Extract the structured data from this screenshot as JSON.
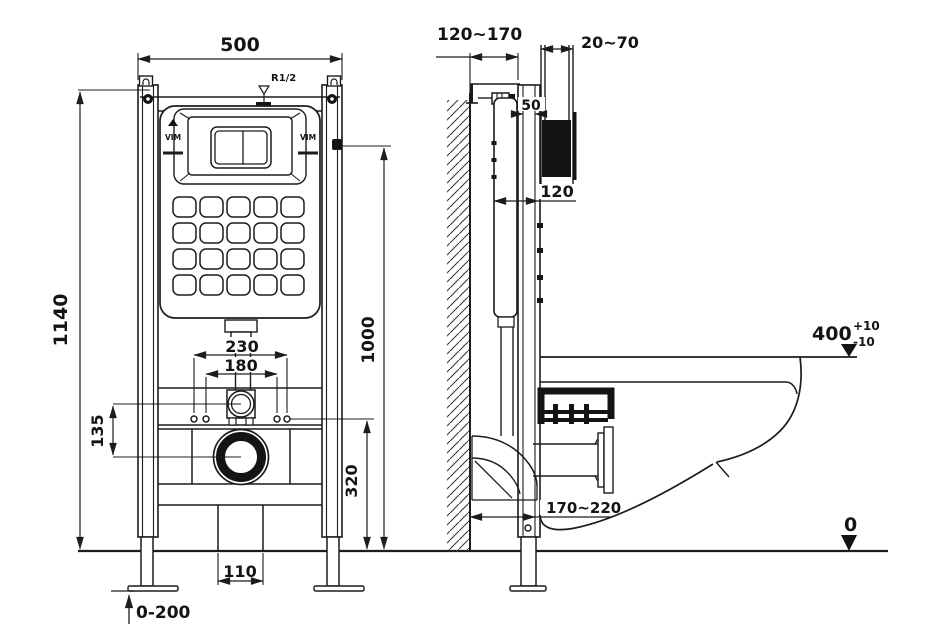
{
  "drawing": {
    "front_view": {
      "frame_width": "500",
      "frame_height": "1140",
      "flush_pipe_spacing": "230",
      "bolt_spacing": "180",
      "axis_offset": "135",
      "outlet_height": "320",
      "upper_height": "1000",
      "floor_bracket_width": "110",
      "leg_adjust": "0-200",
      "inlet_thread": "R1/2",
      "brand": "VIM"
    },
    "side_view": {
      "install_depth_top": "120~170",
      "finish_depth": "20~70",
      "rail_depth": "50",
      "frame_depth": "120",
      "bowl_height": "400",
      "bowl_height_plus": "+10",
      "bowl_height_minus": "-10",
      "install_depth_bottom": "170~220",
      "floor_level": "0"
    },
    "colors": {
      "ink": "#1c1c1c",
      "fill_black": "#141414",
      "paper": "#ffffff"
    }
  }
}
